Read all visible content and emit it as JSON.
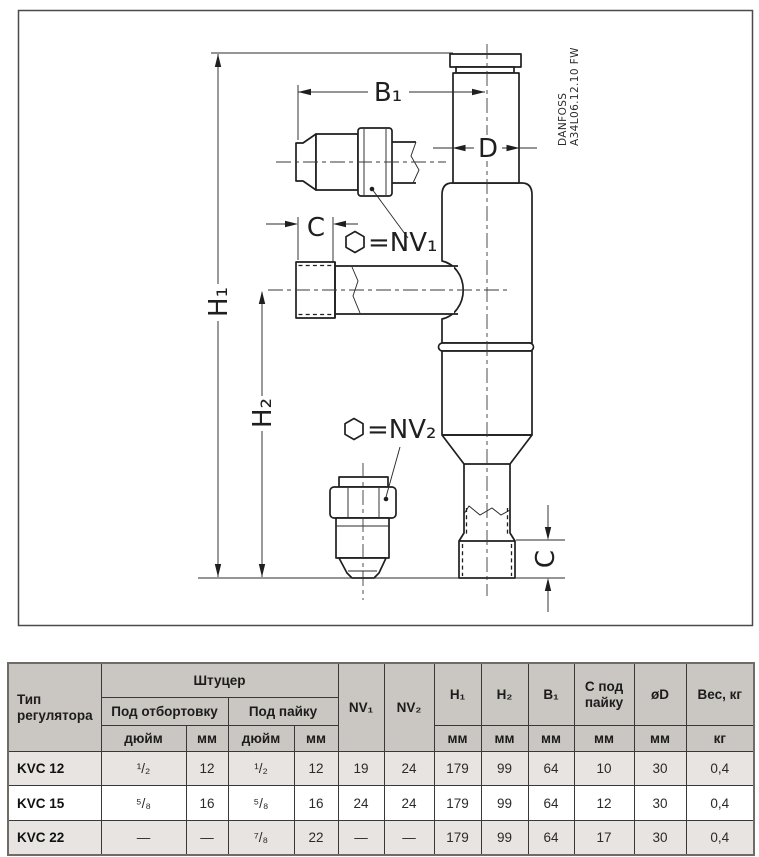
{
  "drawing": {
    "brand_vertical": "DANFOSS",
    "code_vertical": "A34L06.12.10 FW",
    "labels": {
      "b1": "B₁",
      "d": "D",
      "c_top": "C",
      "nv1": "=NV₁",
      "nv2": "=NV₂",
      "h1": "H₁",
      "h2": "H₂",
      "c_bottom": "C"
    }
  },
  "table": {
    "headers": {
      "type": "Тип регулятора",
      "shtucer": "Штуцер",
      "flare": "Под отбортовку",
      "solder": "Под пайку",
      "inch": "дюйм",
      "mm": "мм",
      "kg": "кг",
      "nv1": "NV₁",
      "nv2": "NV₂",
      "h1": "H₁",
      "h2": "H₂",
      "b1": "B₁",
      "c_solder": "С под пайку",
      "dia": "øD",
      "weight": "Вес, кг"
    },
    "rows": [
      {
        "type": "KVC 12",
        "values": [
          "¹/₂",
          "12",
          "¹/₂",
          "12",
          "19",
          "24",
          "179",
          "99",
          "64",
          "10",
          "30",
          "0,4"
        ]
      },
      {
        "type": "KVC 15",
        "values": [
          "⁵/₈",
          "16",
          "⁵/₈",
          "16",
          "24",
          "24",
          "179",
          "99",
          "64",
          "12",
          "30",
          "0,4"
        ]
      },
      {
        "type": "KVC 22",
        "values": [
          "—",
          "—",
          "⁷/₈",
          "22",
          "—",
          "—",
          "179",
          "99",
          "64",
          "17",
          "30",
          "0,4"
        ]
      }
    ]
  },
  "colors": {
    "line": "#1f1f1f",
    "table_border": "#3a3836",
    "header_bg": "#cac6c1",
    "row_alt_bg": "#e7e4e1"
  }
}
